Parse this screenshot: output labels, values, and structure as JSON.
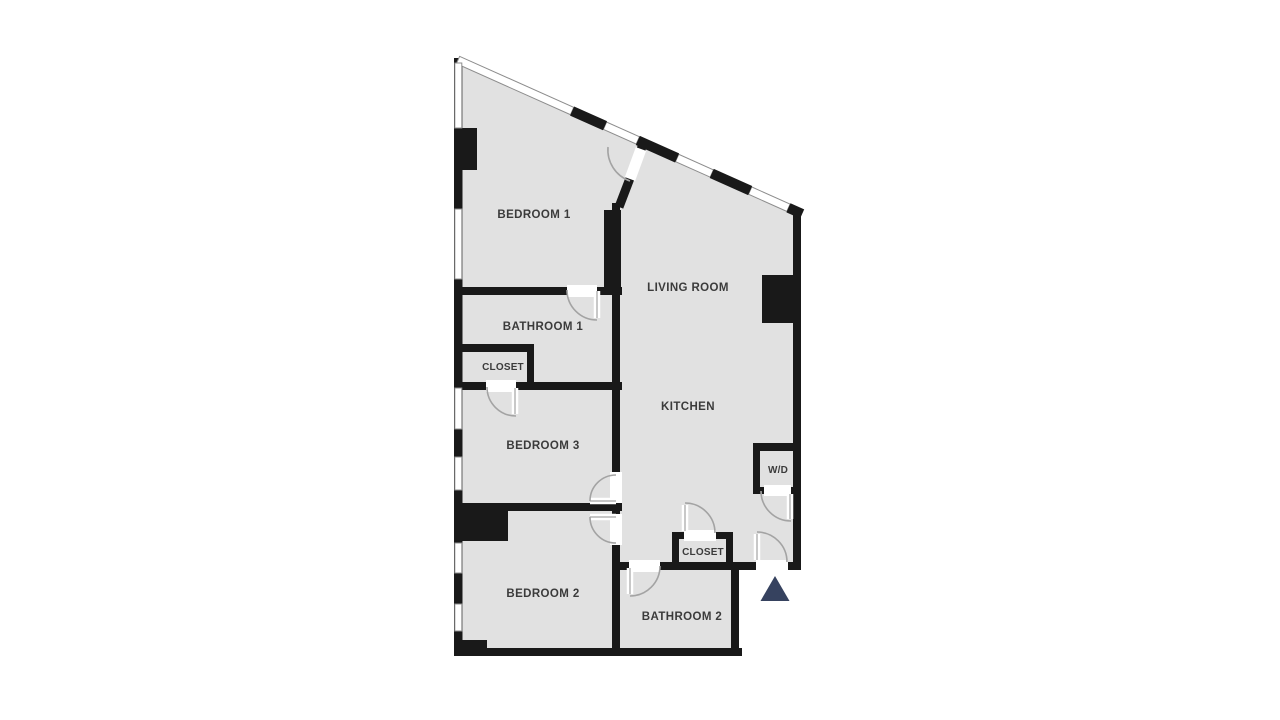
{
  "floorplan": {
    "title": "3-bedroom apartment floor plan",
    "colors": {
      "background": "#ffffff",
      "room_fill": "#e1e1e1",
      "wall": "#191919",
      "window_line": "#8c8c8c",
      "door_arc": "#a3a3a3",
      "label": "#3b3b3b",
      "entry_marker": "#36425f"
    },
    "rooms": [
      {
        "id": "bedroom-1",
        "label": "BEDROOM 1"
      },
      {
        "id": "living-room",
        "label": "LIVING ROOM"
      },
      {
        "id": "bathroom-1",
        "label": "BATHROOM 1"
      },
      {
        "id": "closet-1",
        "label": "CLOSET"
      },
      {
        "id": "bedroom-3",
        "label": "BEDROOM 3"
      },
      {
        "id": "kitchen",
        "label": "KITCHEN"
      },
      {
        "id": "washer-dryer",
        "label": "W/D"
      },
      {
        "id": "closet-2",
        "label": "CLOSET"
      },
      {
        "id": "bedroom-2",
        "label": "BEDROOM 2"
      },
      {
        "id": "bathroom-2",
        "label": "BATHROOM 2"
      }
    ],
    "entry_marker": {
      "shape": "triangle-up",
      "meaning": "entrance"
    }
  }
}
